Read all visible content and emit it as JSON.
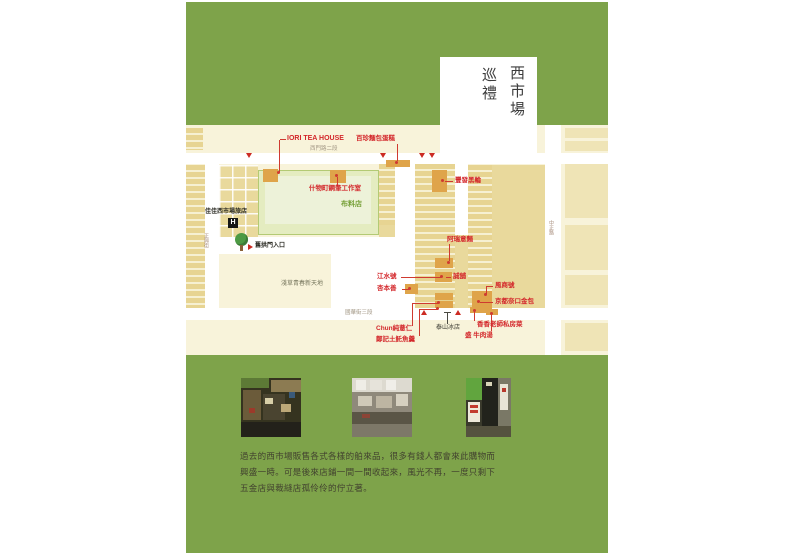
{
  "colors": {
    "page_green": "#7ea34a",
    "map_cream": "#f8f3da",
    "label_red": "#d3262a",
    "highlight_orange": "#dfa44a"
  },
  "title": {
    "market": "西市場",
    "tour": "巡禮"
  },
  "map": {
    "streets": {
      "top": "西門路二段",
      "bottom": "國華街三段",
      "left": "正興街",
      "right": "中正路"
    },
    "areas": {
      "fabric_shop": "布料店",
      "asakusa": "淺草青春新天地"
    },
    "poi": {
      "hotel": "佳佳西市場旅店",
      "hotel_icon": "H",
      "arch_entrance": "舊拱門入口",
      "taishan_ice": "泰山冰店"
    },
    "shops": {
      "iori": "IORI TEA HOUSE",
      "baizhen_bakery": "百珍麵包蛋糕",
      "pen_studio": "什物町鋼筆工作室",
      "fengfa_oden": "豐發黑輪",
      "arui_noodles": "阿瑞意麵",
      "jiangshui_hao": "江水號",
      "xing_ben_shan": "杏本善",
      "cheng_pu": "誠舖",
      "feng_shang_hao": "風商號",
      "kyoto_na_purse": "京都奈口金包",
      "xiangxiang_kitchen": "香香老師私房菜",
      "sheng_beef_soup": "盛 牛肉湯",
      "chun_barley": "Chun純薏仁",
      "zhengji_fish": "鄭記土魠魚羹"
    }
  },
  "caption": {
    "line1": "過去的西市場販售各式各樣的舶來品，很多有錢人都會來此購物而",
    "line2": "興盛一時。可是後來店鋪一間一間收起來，風光不再，一度只剩下",
    "line3": "五金店與裁縫店孤伶伶的佇立著。"
  }
}
